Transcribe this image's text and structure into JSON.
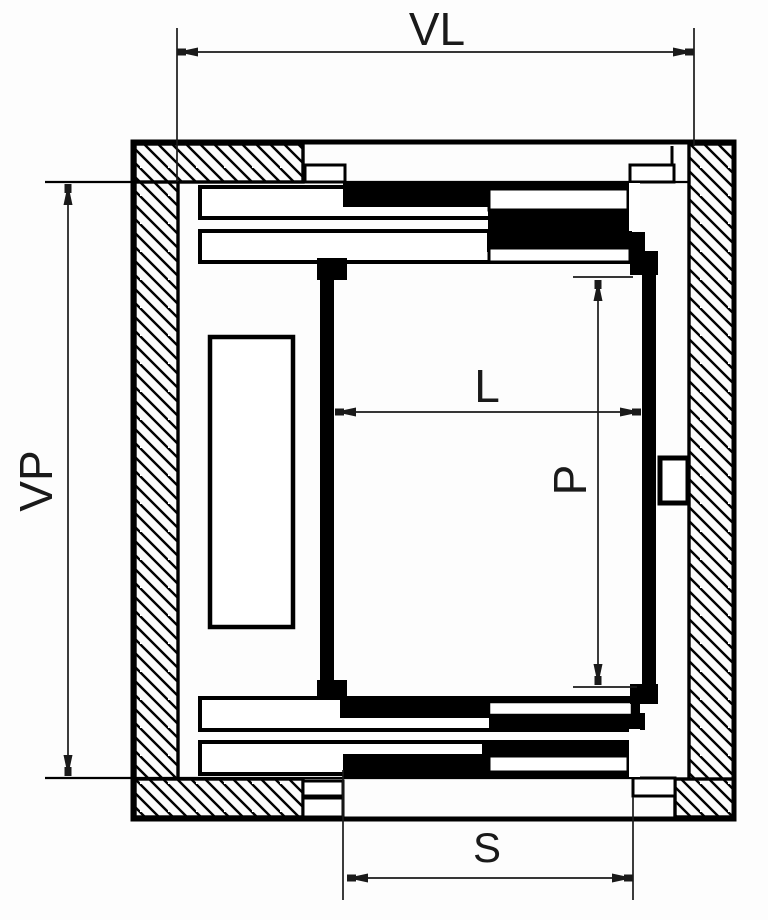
{
  "diagram": {
    "type": "technical-drawing",
    "dimensions": {
      "vl": {
        "label": "VL"
      },
      "vp": {
        "label": "VP"
      },
      "l": {
        "label": "L"
      },
      "p": {
        "label": "P"
      },
      "s": {
        "label": "S"
      }
    },
    "colors": {
      "line": "#000000",
      "background": "#fdfdfd",
      "fill_solid": "#000000",
      "fill_open": "#ffffff"
    }
  }
}
